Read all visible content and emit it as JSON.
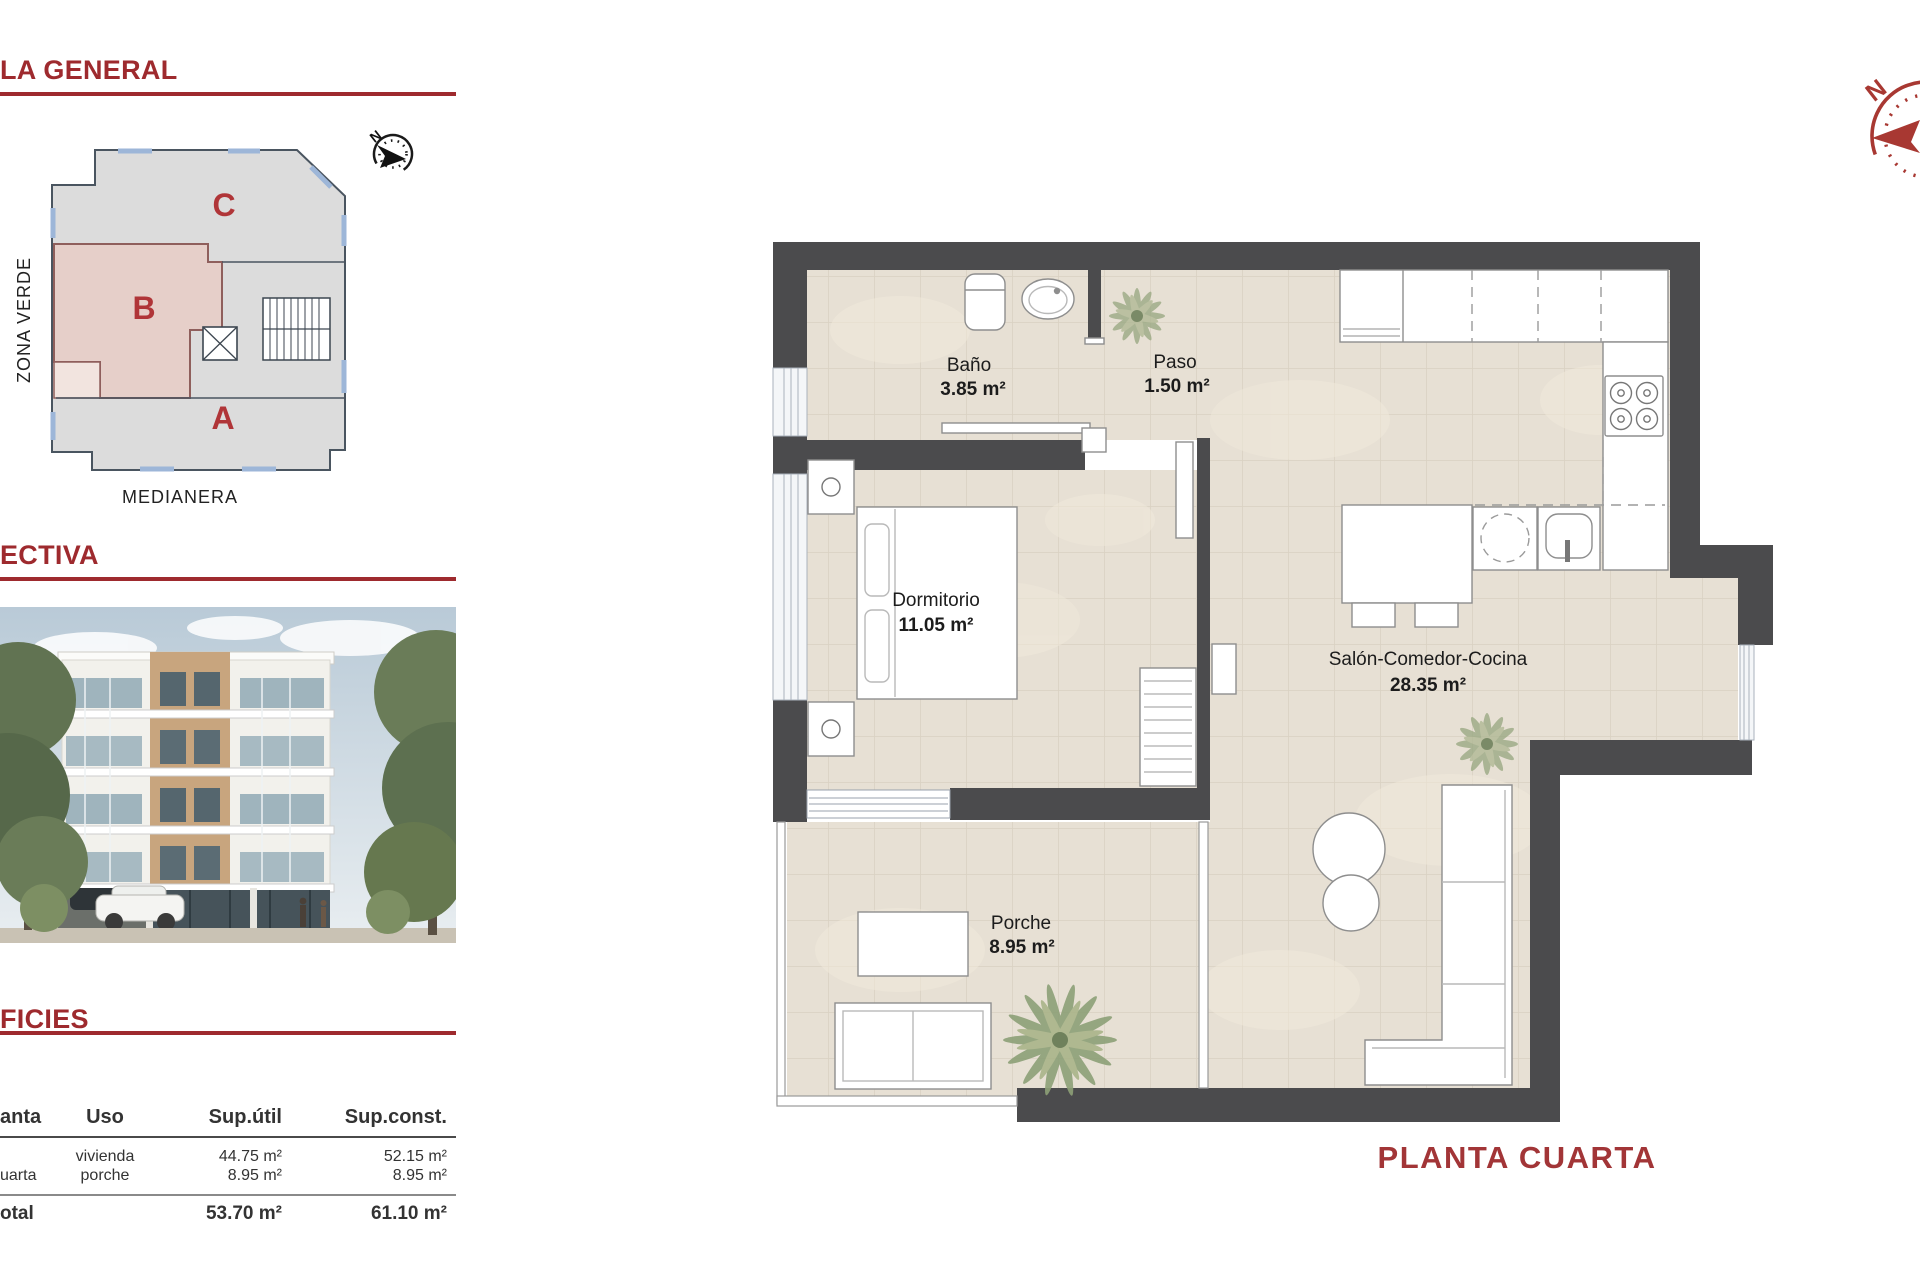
{
  "sections": {
    "general_title": "LA GENERAL",
    "perspective_title": "ECTIVA",
    "surfaces_title": "FICIES"
  },
  "site_plan": {
    "zone_c": "C",
    "zone_b": "B",
    "zone_a": "A",
    "zona_verde": "ZONA VERDE",
    "medianera": "MEDIANERA",
    "compass_north": "N"
  },
  "surfaces_table": {
    "headers": {
      "planta": "anta",
      "uso": "Uso",
      "sup_util": "Sup.útil",
      "sup_const": "Sup.const."
    },
    "row": {
      "planta": "uarta",
      "uso_line1": "vivienda",
      "uso_line2": "porche",
      "util_line1": "44.75 m²",
      "util_line2": "8.95 m²",
      "const_line1": "52.15 m²",
      "const_line2": "8.95 m²"
    },
    "total": {
      "label": "otal",
      "util": "53.70 m²",
      "const": "61.10 m²"
    }
  },
  "floor_plan": {
    "title": "PLANTA CUARTA",
    "compass_north": "N",
    "rooms": [
      {
        "name": "Baño",
        "area": "3.85 m²"
      },
      {
        "name": "Paso",
        "area": "1.50 m²"
      },
      {
        "name": "Dormitorio",
        "area": "11.05 m²"
      },
      {
        "name": "Salón-Comedor-Cocina",
        "area": "28.35 m²"
      },
      {
        "name": "Porche",
        "area": "8.95 m²"
      }
    ]
  },
  "colors": {
    "accent_red": "#9e2a2e",
    "plan_title_red": "#a23537",
    "wall_gray": "#4b4b4d"
  }
}
